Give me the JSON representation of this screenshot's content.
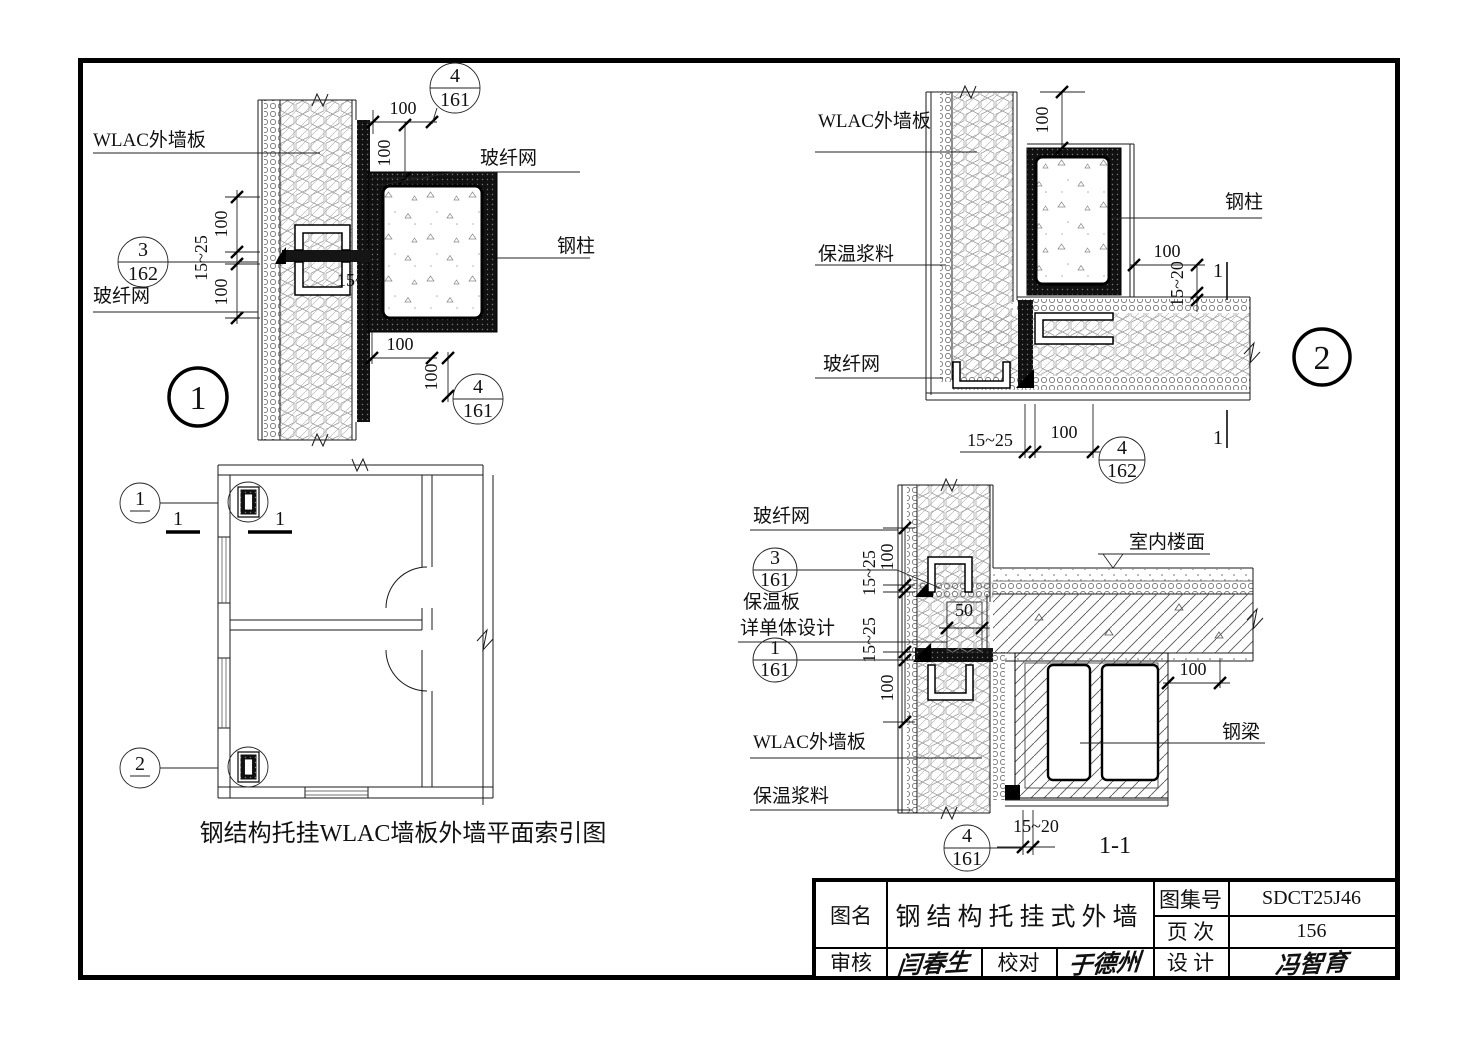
{
  "labels": {
    "wlac_panel": "WLAC外墙板",
    "fiberglass_mesh": "玻纤网",
    "steel_column": "钢柱",
    "steel_beam": "钢梁",
    "insulation_mortar": "保温浆料",
    "insulation_board_line1": "保温板",
    "insulation_board_line2": "详单体设计",
    "indoor_floor": "室内楼面"
  },
  "dims": {
    "d100": "100",
    "d15_25": "15~25",
    "d15_20": "15~20",
    "d50": "50"
  },
  "refs": {
    "r4_161": {
      "num": "4",
      "page": "161"
    },
    "r3_162": {
      "num": "3",
      "page": "162"
    },
    "r4_162": {
      "num": "4",
      "page": "162"
    },
    "r3_161": {
      "num": "3",
      "page": "161"
    },
    "r1_161": {
      "num": "1",
      "page": "161"
    }
  },
  "details": {
    "one": "1",
    "two": "2"
  },
  "marks": {
    "cut": "1"
  },
  "plan": {
    "ref1": "1",
    "ref2": "2",
    "caption": "钢结构托挂WLAC墙板外墙平面索引图"
  },
  "section": {
    "caption": "1-1"
  },
  "titleblock": {
    "fig_name_label": "图名",
    "fig_name": "钢结构托挂式外墙",
    "atlas_label": "图集号",
    "atlas_no": "SDCT25J46",
    "page_label": "页 次",
    "page_no": "156",
    "review_label": "审核",
    "review_sig": "闫春生",
    "proof_label": "校对",
    "proof_sig": "于德州",
    "design_label": "设 计",
    "design_sig": "冯智育"
  },
  "colors": {
    "line": "#000000",
    "paper": "#ffffff"
  }
}
